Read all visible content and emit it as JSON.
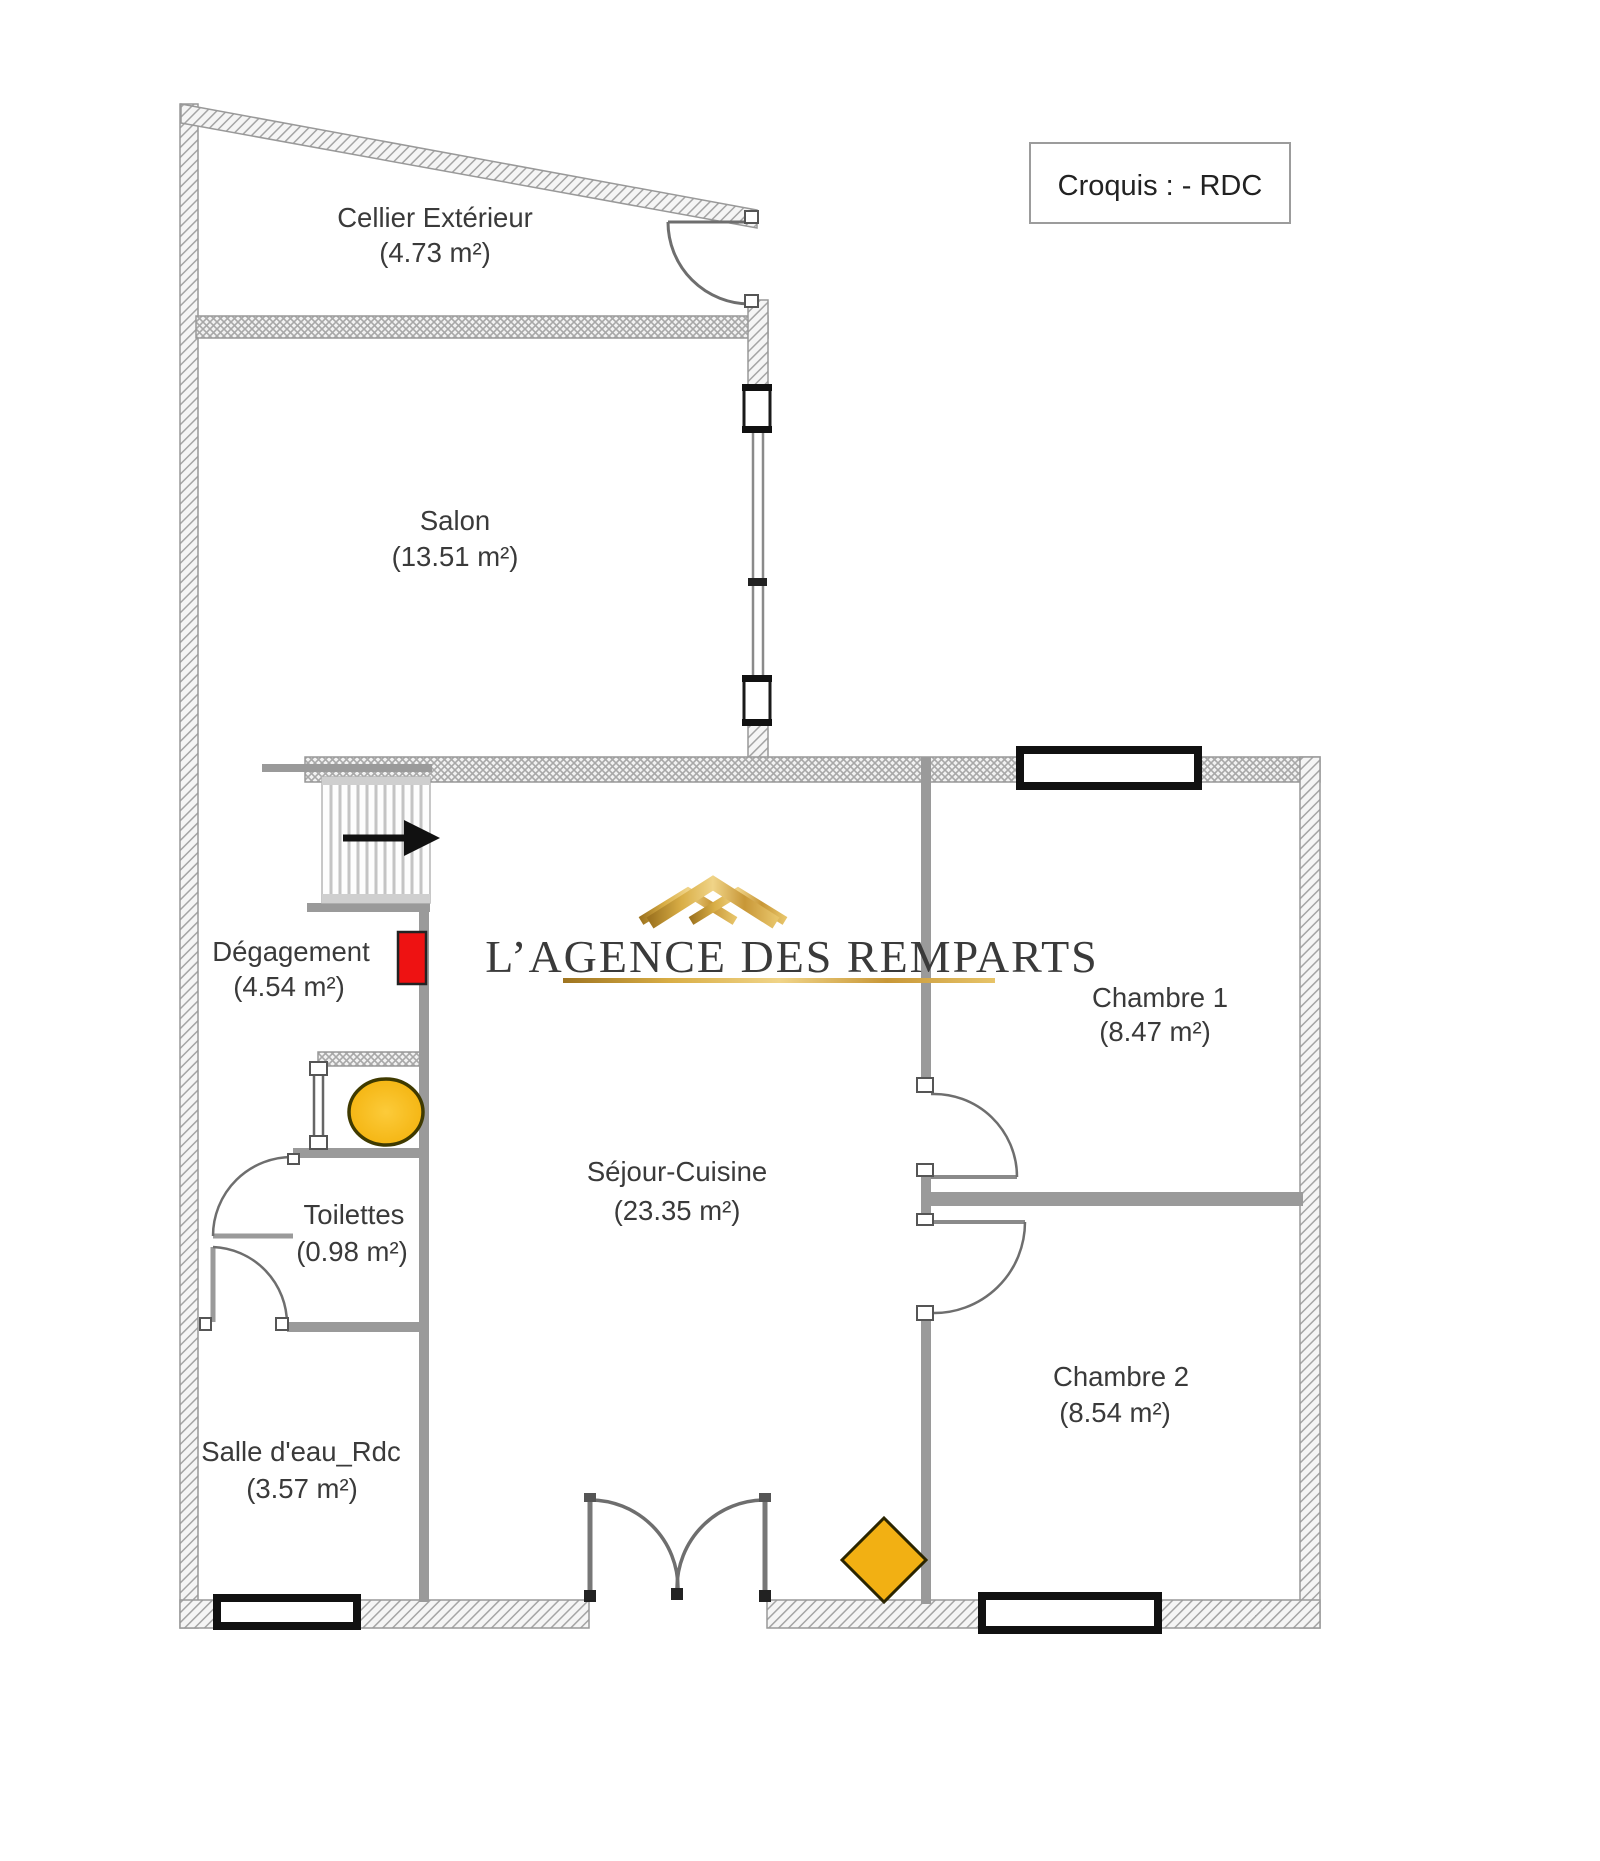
{
  "header": {
    "title": "Croquis : - RDC"
  },
  "watermark": {
    "text": "L’AGENCE DES REMPARTS",
    "roof_icon": "gold-roof-icon",
    "gold_color": "#c79a33"
  },
  "rooms": {
    "cellier": {
      "name": "Cellier Extérieur",
      "area": "(4.73 m²)"
    },
    "salon": {
      "name": "Salon",
      "area": "(13.51 m²)"
    },
    "degagement": {
      "name": "Dégagement",
      "area": "(4.54 m²)"
    },
    "toilettes": {
      "name": "Toilettes",
      "area": "(0.98 m²)"
    },
    "salle_deau": {
      "name": "Salle d'eau_Rdc",
      "area": "(3.57 m²)"
    },
    "sejour": {
      "name": "Séjour-Cuisine",
      "area": "(23.35 m²)"
    },
    "chambre1": {
      "name": "Chambre 1",
      "area": "(8.47 m²)"
    },
    "chambre2": {
      "name": "Chambre 2",
      "area": "(8.54 m²)"
    }
  },
  "symbols": {
    "stairs_direction": "arrow-right",
    "red_marker_color": "#ee1212",
    "toilet_fixture_color": "#f6b90e",
    "diamond_marker_color": "#f2b013",
    "wall_color": "#9a9a9a"
  }
}
